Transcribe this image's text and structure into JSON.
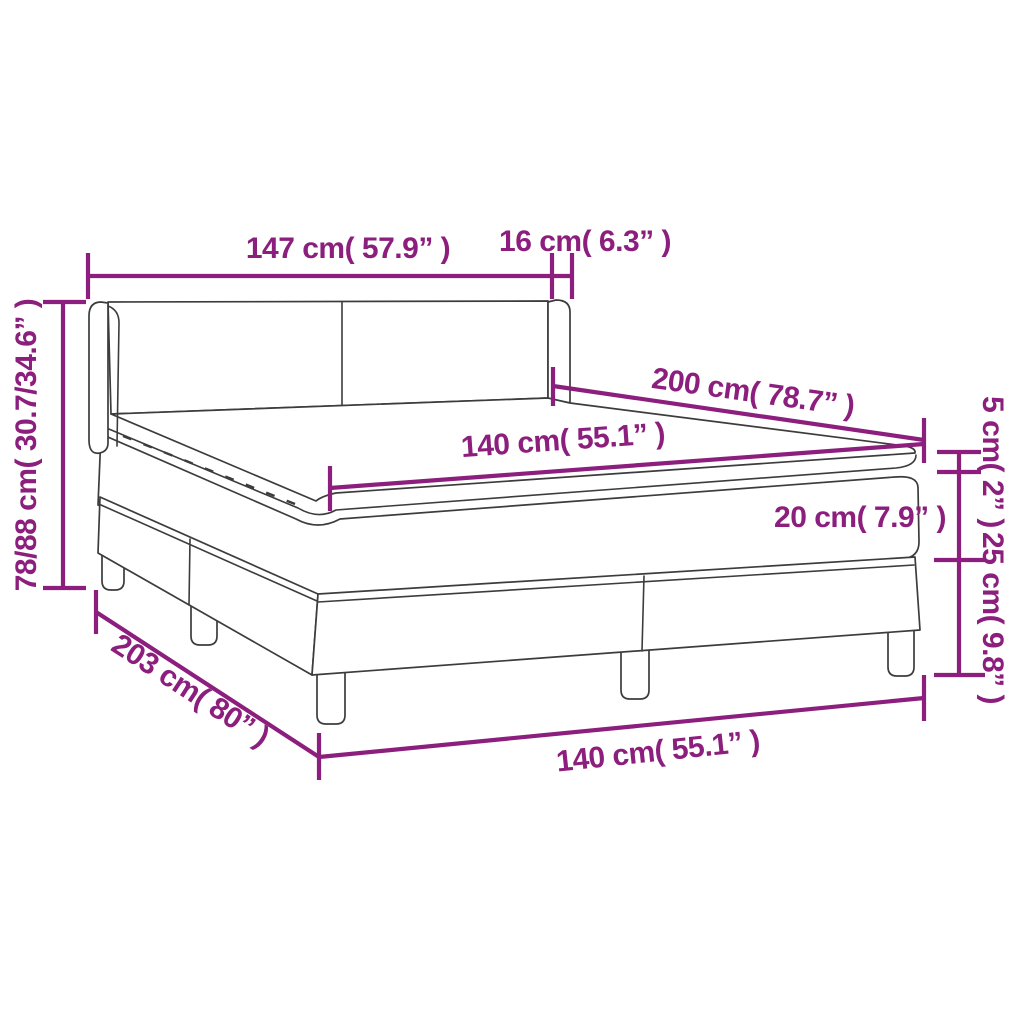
{
  "diagram": {
    "type": "product-dimension-diagram",
    "product": "box-spring-bed-with-mattress-and-topper",
    "colors": {
      "accent": "#8C1E7D",
      "line": "#3C3C3C",
      "background": "#FFFFFF"
    },
    "labels": {
      "headboard_width": "147 cm( 57.9” )",
      "headboard_depth": "16 cm( 6.3” )",
      "total_height": "78/88 cm( 30.7/34.6” )",
      "bed_length": "200 cm( 78.7” )",
      "mattress_width": "140 cm( 55.1” )",
      "topper_height": "5 cm( 2” )",
      "mattress_height": "20 cm( 7.9” )",
      "base_height": "25 cm( 9.8” )",
      "base_length": "203 cm( 80” )",
      "base_width": "140 cm( 55.1” )"
    }
  }
}
